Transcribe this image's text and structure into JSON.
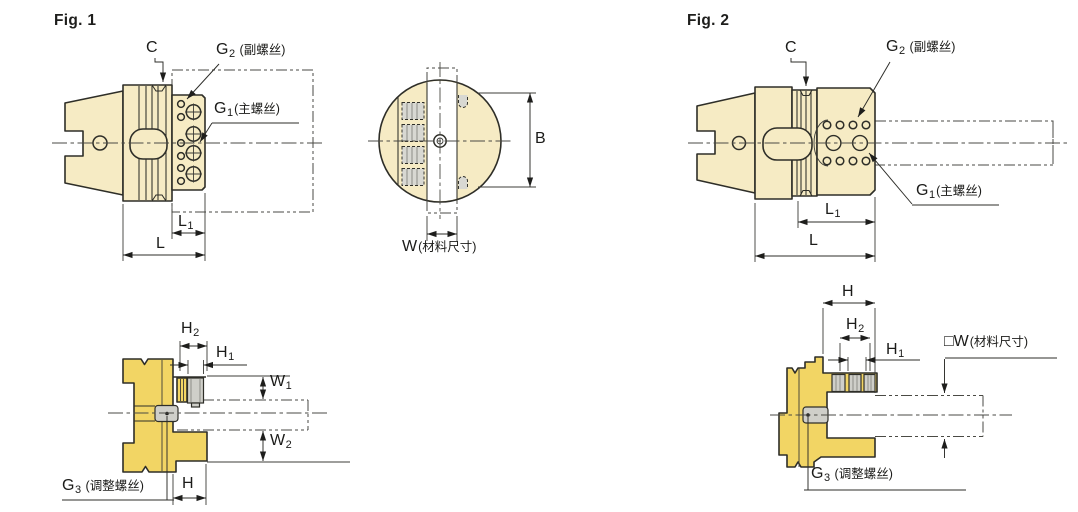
{
  "colors": {
    "body": "#F6EBC4",
    "section": "#F2D564",
    "outline": "#2E2E28",
    "screw": "#CFCFC9"
  },
  "fig1": {
    "title": "Fig. 1",
    "c": "C",
    "g2": {
      "letter": "G",
      "sub": "2",
      "note": " (副螺丝)"
    },
    "g1": {
      "letter": "G",
      "sub": "1",
      "note": "(主螺丝)"
    },
    "l1": {
      "letter": "L",
      "sub": "1"
    },
    "l": "L"
  },
  "front_view": {
    "b": "B",
    "w": {
      "letter": "W",
      "note": "(材料尺寸)"
    }
  },
  "fig2": {
    "title": "Fig. 2",
    "c": "C",
    "g2": {
      "letter": "G",
      "sub": "2",
      "note": " (副螺丝)"
    },
    "g1": {
      "letter": "G",
      "sub": "1",
      "note": "(主螺丝)"
    },
    "l1": {
      "letter": "L",
      "sub": "1"
    },
    "l": "L"
  },
  "section_left": {
    "h2": {
      "letter": "H",
      "sub": "2"
    },
    "h1": {
      "letter": "H",
      "sub": "1"
    },
    "w1": {
      "letter": "W",
      "sub": "1"
    },
    "w2": {
      "letter": "W",
      "sub": "2"
    },
    "g3": {
      "letter": "G",
      "sub": "3",
      "note": " (调整螺丝)"
    },
    "h": "H"
  },
  "section_right": {
    "h": "H",
    "h2": {
      "letter": "H",
      "sub": "2"
    },
    "h1": {
      "letter": "H",
      "sub": "1"
    },
    "w": {
      "letter": "□W",
      "note": "(材料尺寸)"
    },
    "g3": {
      "letter": "G",
      "sub": "3",
      "note": " (调整螺丝)"
    }
  }
}
